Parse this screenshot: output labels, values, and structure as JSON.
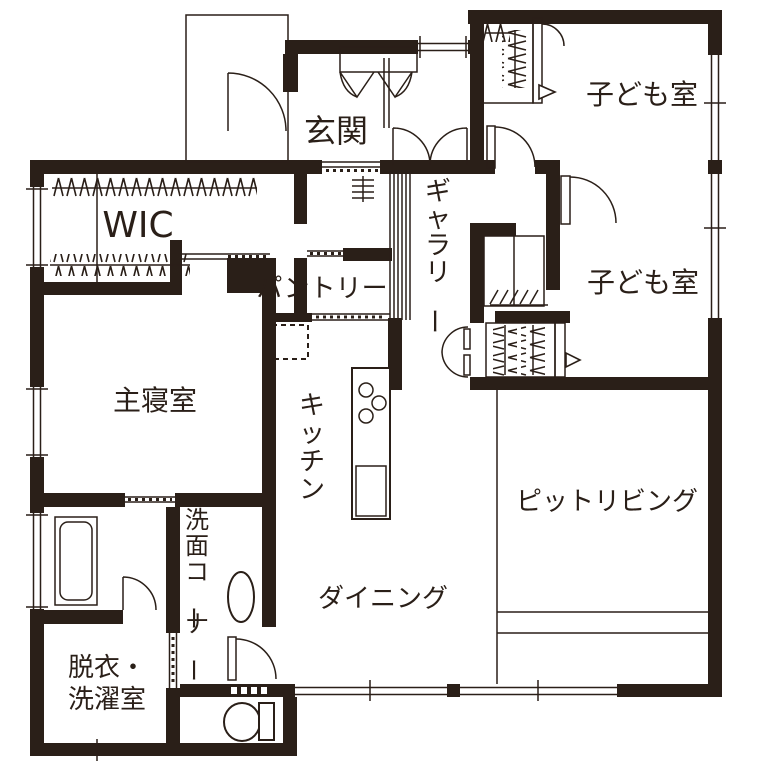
{
  "colors": {
    "wall": "#2a1f18",
    "background": "#ffffff"
  },
  "rooms": [
    {
      "id": "genkan",
      "label": "玄関"
    },
    {
      "id": "wic",
      "label": "WIC"
    },
    {
      "id": "pantry",
      "label": "パントリー"
    },
    {
      "id": "gallery",
      "label": "ギャラリー",
      "vertical": true
    },
    {
      "id": "kids_room_1",
      "label": "子ども室"
    },
    {
      "id": "kids_room_2",
      "label": "子ども室"
    },
    {
      "id": "master_bedroom",
      "label": "主寝室"
    },
    {
      "id": "kitchen",
      "label": "キッチン",
      "vertical": true
    },
    {
      "id": "pit_living",
      "label": "ピットリビング"
    },
    {
      "id": "dining",
      "label": "ダイニング"
    },
    {
      "id": "wash_corner",
      "label": "洗面コーナー",
      "vertical": true
    },
    {
      "id": "laundry",
      "label_line1": "脱衣・",
      "label_line2": "洗濯室"
    }
  ],
  "fixtures": {
    "entrance_porch": "entrance porch outline",
    "entrance_door": "hinged entry door arc",
    "shoe_cabinet": "bifold-door shoe cabinet",
    "hall_double_door": "double swing doors to hall",
    "wic_hanger_racks": "hanger pipe with hatch marks",
    "louver_screen": "vertical slat screen beside gallery",
    "display_niche": "display niche ticks",
    "refrigerator_space": "dashed refrigerator square",
    "kitchen_island": "island counter with 3-burner stove and sink",
    "pit_step": "sunken living step lines",
    "bathtub": "bathtub",
    "wash_basin": "oval wash basin",
    "toilet": "toilet with tank",
    "closet_shelf_hatch": "shelf diagonal hatch",
    "sliding_doors": "thin double-line sliding doors with dotted tracks",
    "windows": "double-line window sections with end ticks"
  }
}
